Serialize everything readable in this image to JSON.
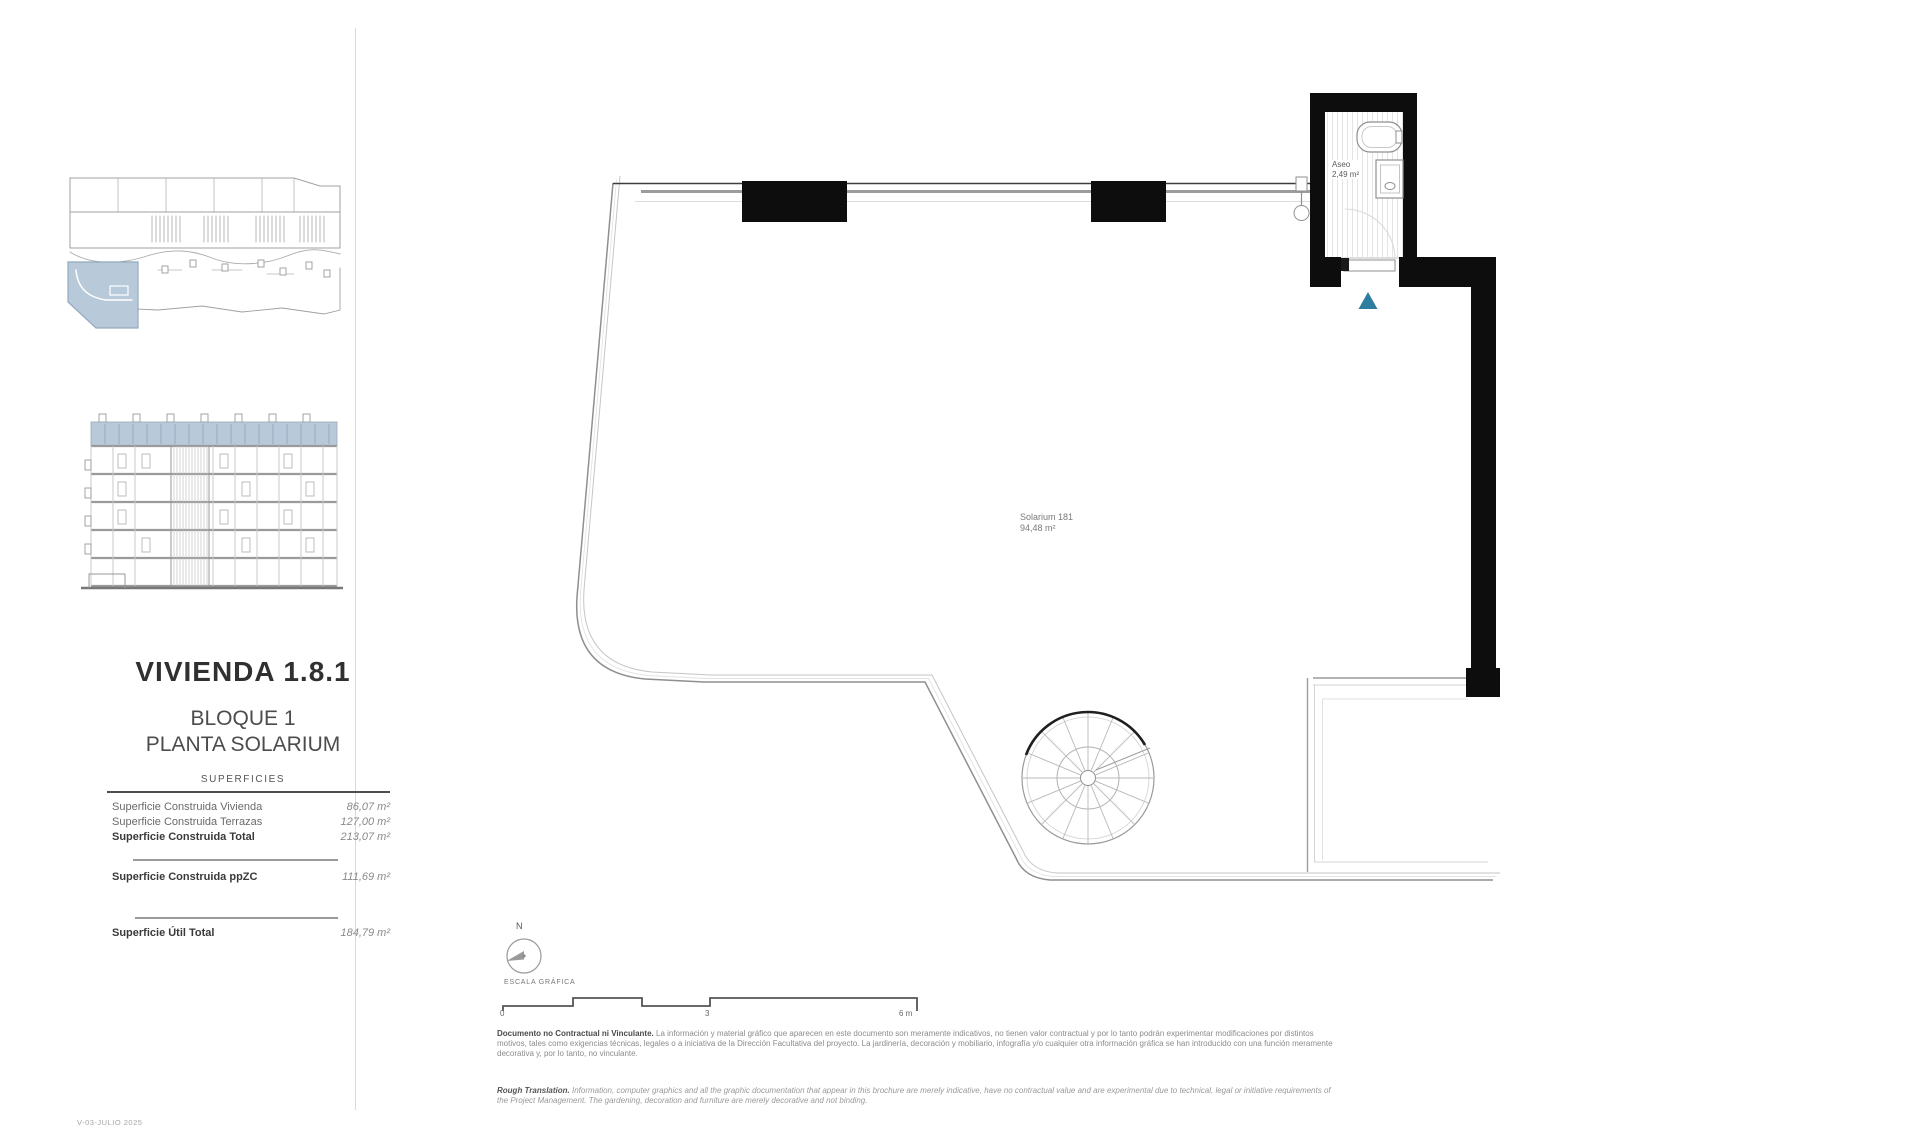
{
  "sidebar": {
    "title": "VIVIENDA 1.8.1",
    "block": "BLOQUE 1",
    "floor": "PLANTA SOLARIUM",
    "surfaces": {
      "heading": "SUPERFICIES",
      "rows": [
        {
          "label": "Superficie Construida Vivienda",
          "value": "86,07 m²"
        },
        {
          "label": "Superficie Construida Terrazas",
          "value": "127,00 m²"
        },
        {
          "label": "Superficie Construida Total",
          "value": "213,07 m²"
        },
        {
          "label": "Superficie Construida ppZC",
          "value": "111,69 m²"
        },
        {
          "label": "Superficie Útil Total",
          "value": "184,79 m²"
        }
      ]
    }
  },
  "plan": {
    "solarium_name": "Solarium 181",
    "solarium_area": "94,48 m²",
    "aseo_name": "Aseo",
    "aseo_area": "2,49 m²",
    "entry_marker_color": "#2e7f9f",
    "highlight_color": "#b8c9da"
  },
  "compass": {
    "label": "N"
  },
  "scale_bar": {
    "title": "ESCALA GRÁFICA",
    "tick0": "0",
    "tick1": "3",
    "tick2": "6 m"
  },
  "footnotes": {
    "es_lead": "Documento no Contractual ni Vinculante.",
    "es_body": " La información y material gráfico que aparecen en este documento son meramente indicativos, no tienen valor contractual y por lo tanto podrán experimentar modificaciones por distintos motivos, tales como exigencias técnicas, legales o a iniciativa de la Dirección Facultativa del proyecto. La jardinería, decoración y mobiliario, infografía y/o cualquier otra información gráfica se han introducido con una función meramente decorativa y, por lo tanto, no vinculante.",
    "en_lead": "Rough Translation.",
    "en_body": " Information, computer graphics and all the graphic documentation that appear in this brochure are merely indicative, have no contractual value and are experimental due to technical, legal or initiative requirements of the Project Management. The gardening, decoration and furniture are merely decorative and not binding."
  },
  "meta": {
    "version_label": "V-03-JULIO 2025"
  }
}
